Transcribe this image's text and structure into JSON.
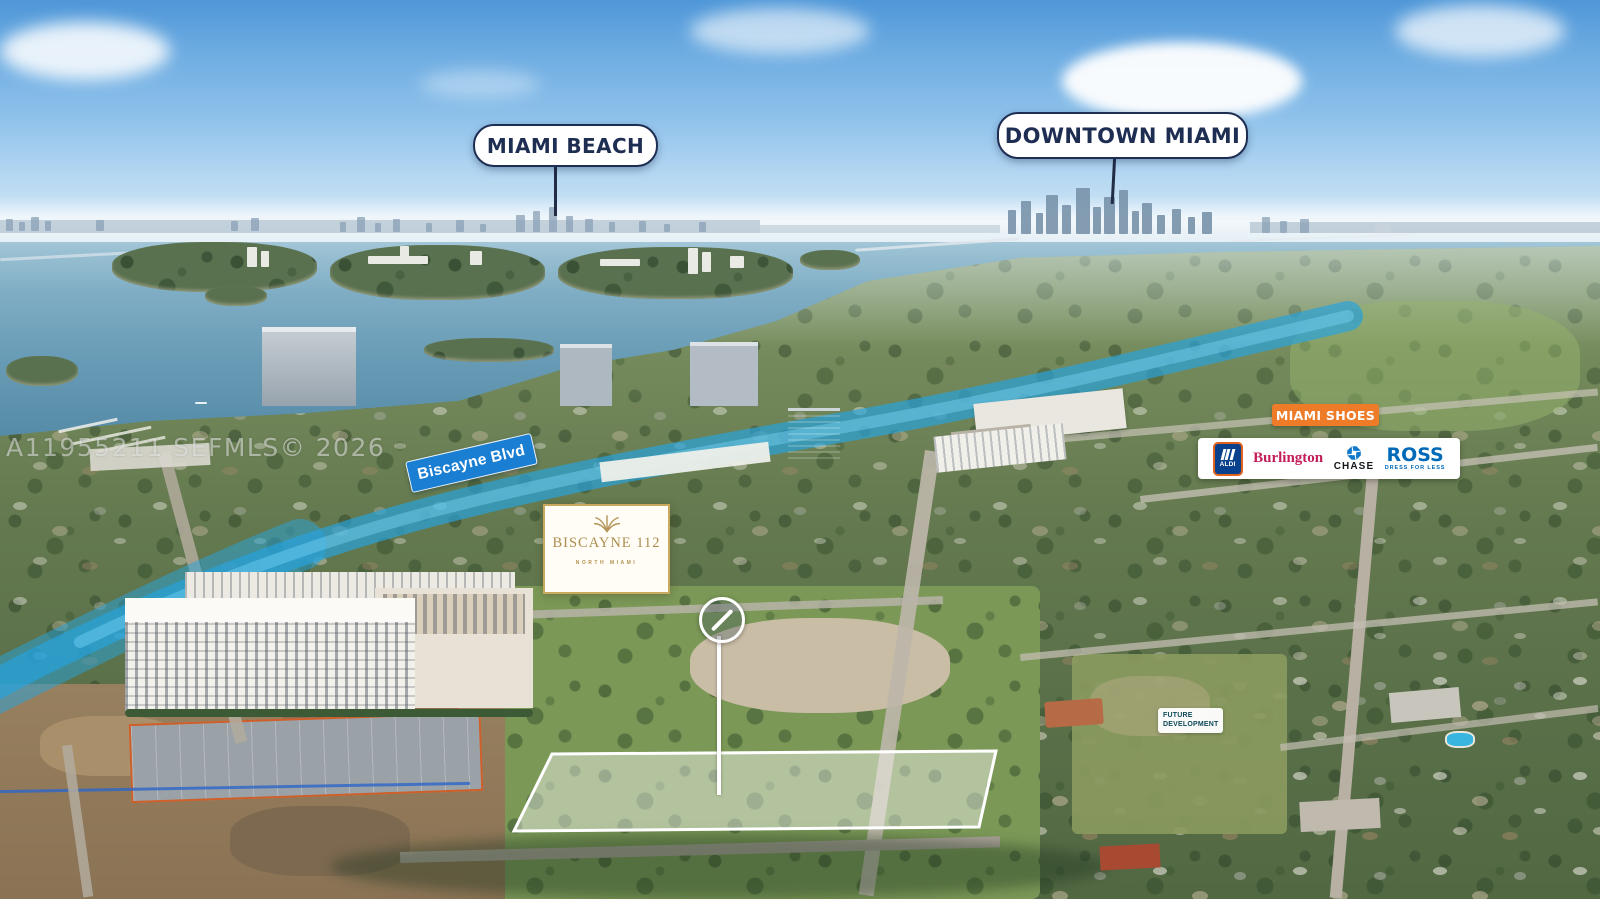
{
  "watermark": "A11955211  SEFMLS© 2026",
  "callouts": {
    "miami_beach": "MIAMI BEACH",
    "downtown_miami": "DOWNTOWN MIAMI"
  },
  "street_sign": "Biscayne Blvd",
  "property_brand": {
    "name": "BISCAYNE 112",
    "subtitle": "NORTH MIAMI",
    "icon": "palm-fan-icon"
  },
  "retail_callout": {
    "banner": "MIAMI SHOES",
    "tenants": {
      "aldi": "ALDI",
      "burlington": "Burlington",
      "chase": "CHASE",
      "ross": "ROSS",
      "ross_tagline": "DRESS FOR LESS"
    }
  },
  "area_label": {
    "line1": "FUTURE",
    "line2": "DEVELOPMENT"
  },
  "icons": {
    "marker": "circle-slash-icon",
    "chase": "chase-octagon-icon",
    "aldi": "aldi-stripes-icon",
    "brand": "palm-fan-icon"
  },
  "colors": {
    "callout_navy": "#1e2d52",
    "street_sign_blue": "#1a7ed2",
    "canal_highlight": "#26a4de",
    "brand_gold": "#ac8d4e",
    "banner_orange": "#ed7b28",
    "aldi_blue": "#09418c",
    "burlington_red": "#c31e5a",
    "chase_blue": "#1178ca",
    "ross_blue": "#0069b8",
    "parcel_outline": "#ffffff"
  }
}
